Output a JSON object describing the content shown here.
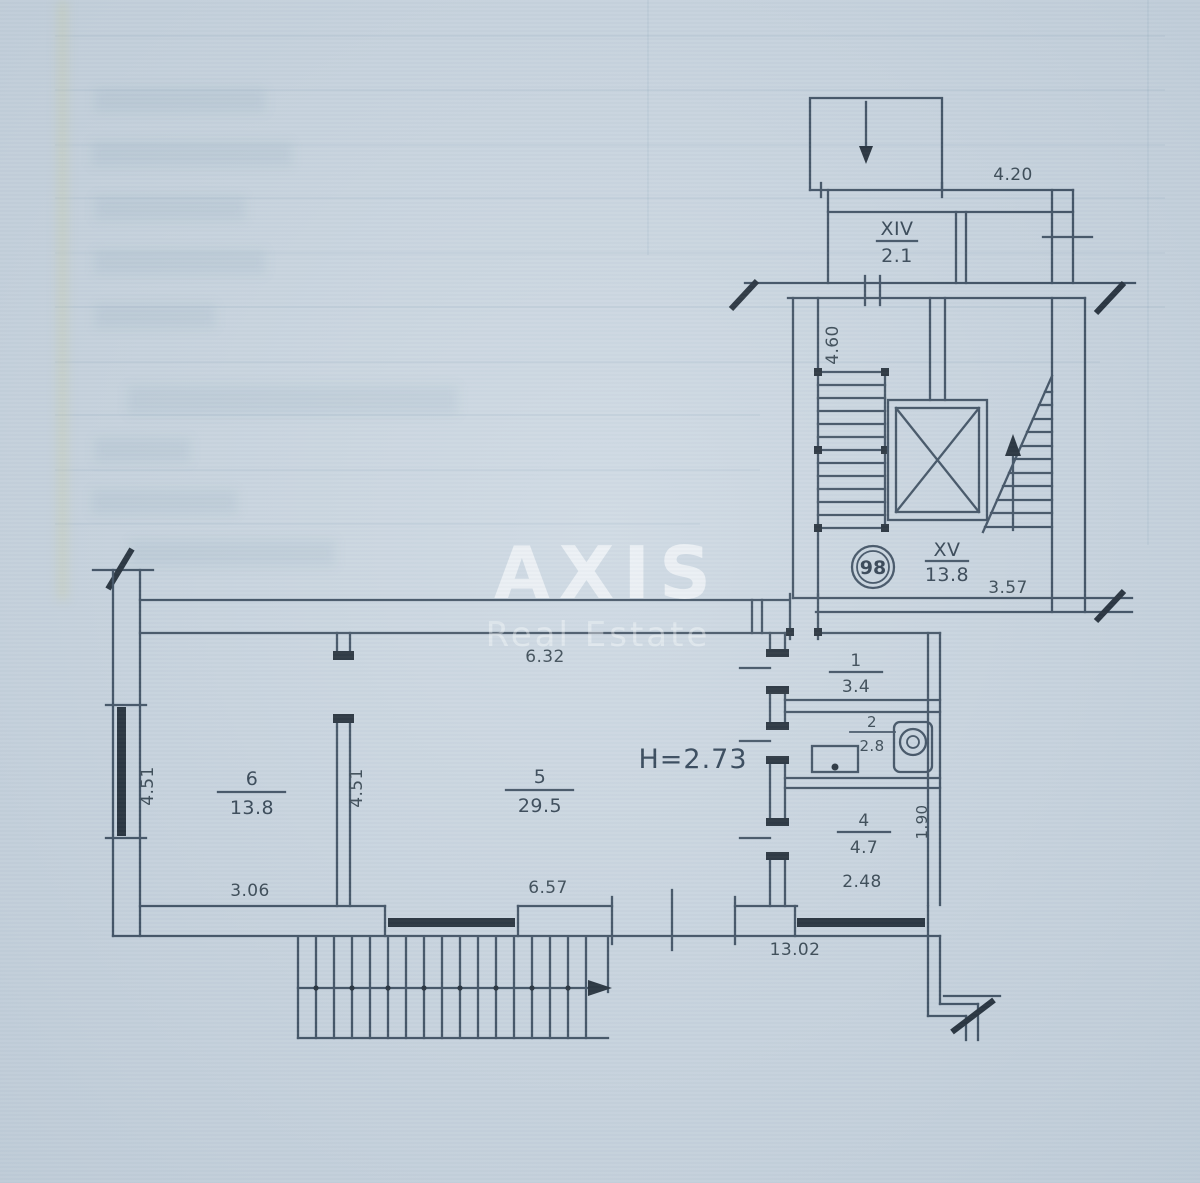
{
  "watermark": {
    "brand": "AXIS",
    "tagline": "Real Estate"
  },
  "plan": {
    "apartment_number": "98",
    "ceiling_height_label": "H=2.73",
    "rooms": {
      "r1": {
        "number": "1",
        "area": "3.4"
      },
      "r2": {
        "number": "2",
        "area": "2.8"
      },
      "r4": {
        "number": "4",
        "area": "4.7"
      },
      "r5": {
        "number": "5",
        "area": "29.5"
      },
      "r6": {
        "number": "6",
        "area": "13.8"
      },
      "xiv": {
        "number": "XIV",
        "area": "2.1"
      },
      "xv": {
        "number": "XV",
        "area": "13.8"
      }
    },
    "dimensions": {
      "balcony_width": "4.20",
      "stairwell_depth": "4.60",
      "landing_width": "3.57",
      "room5_top": "6.32",
      "room5_bottom": "6.57",
      "room5_left": "4.51",
      "room6_left": "4.51",
      "room6_bottom": "3.06",
      "room4_bottom": "2.48",
      "room4_right": "1.90",
      "overall_bottom": "13.02"
    }
  }
}
